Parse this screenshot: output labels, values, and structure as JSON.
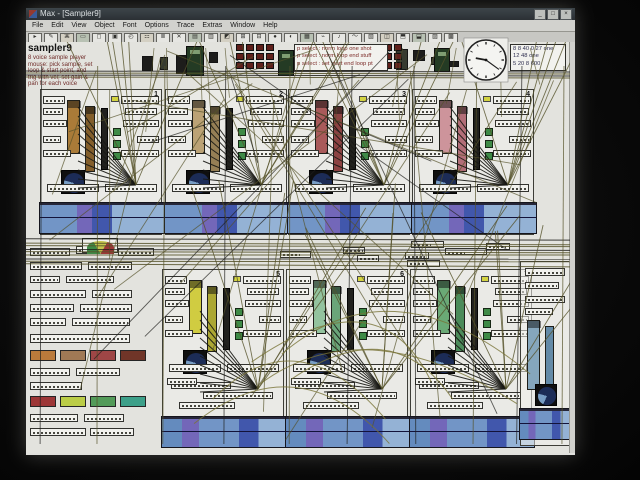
{
  "window": {
    "title": "Max - [Sampler9]",
    "buttons": [
      "_",
      "□",
      "×"
    ]
  },
  "menu": {
    "items": [
      "File",
      "Edit",
      "View",
      "Object",
      "Font",
      "Options",
      "Trace",
      "Extras",
      "Window",
      "Help"
    ]
  },
  "toolbar": {
    "icons": [
      "▸",
      "✎",
      "⌘",
      "▭",
      "◻",
      "▣",
      "◴",
      "☷",
      "≣",
      "✕",
      "▤",
      "▥",
      "◩",
      "⊞",
      "⊟",
      "●",
      "◐",
      "▦",
      "⌁",
      "♪",
      "〜",
      "▧",
      "◫",
      "⬒",
      "⬓",
      "▨",
      "▩"
    ]
  },
  "patch": {
    "title": "sampler9",
    "comments": [
      "8 voice sample player",
      "mouse: pick sample, set",
      "loop & start point, and",
      "trig with vel; set gain &",
      "pan for each voice"
    ],
    "message_group_1": {
      "lines": [
        "p select : norm loop one shot",
        "p select : norm loop end stuff",
        "p select : set start end loop pt"
      ]
    },
    "message_group_2": {
      "lines": [
        "8 8 40 0 27 one",
        "12 48 one",
        "5 20 8 600"
      ]
    },
    "clock": {
      "time": "9:21"
    },
    "voices": [
      {
        "label": "1",
        "color": "#b57a26",
        "color2": "#8a5c1c"
      },
      {
        "label": "2",
        "color": "#c2a36a",
        "color2": "#9a7f4a"
      },
      {
        "label": "3",
        "color": "#b85555",
        "color2": "#9a3d3d"
      },
      {
        "label": "4",
        "color": "#d9929b",
        "color2": "#c06a76"
      },
      {
        "label": "5",
        "color": "#d6d022",
        "color2": "#b0aa18"
      },
      {
        "label": "6",
        "color": "#8cc89a",
        "color2": "#5faa72"
      },
      {
        "label": "7",
        "color": "#5fae6e",
        "color2": "#3f8f52"
      },
      {
        "label": "",
        "color": "#7fa8c4",
        "color2": "#5b8cb0"
      }
    ],
    "preset_colors_row1": [
      "#c87828",
      "#a8784a",
      "#b04040",
      "#7a3020"
    ],
    "preset_colors_row2": [
      "#b03030",
      "#bcd22a",
      "#46a04e",
      "#2aa689"
    ]
  },
  "colors": {
    "cord_olive": "#55511e",
    "cord_dark": "#1c1c18",
    "waveform_blue": "#6a97d4",
    "waveform_purple": "#7464cc",
    "dial_blue": "#6f9fd0"
  }
}
